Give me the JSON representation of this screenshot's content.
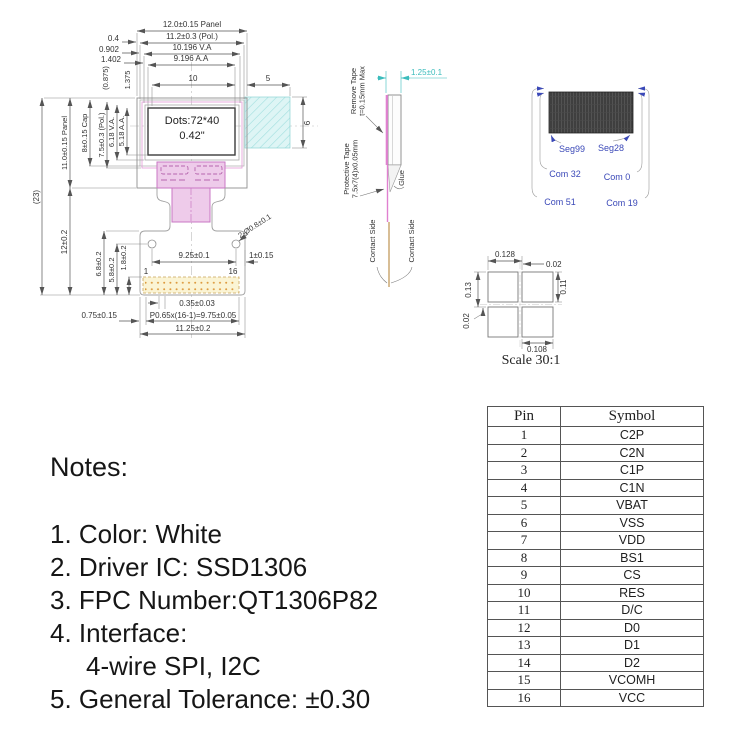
{
  "front_view": {
    "display": {
      "line1": "Dots:72*40",
      "line2": "0.42\""
    },
    "top": {
      "panel": "12.0±0.15 Panel",
      "pol": "11.2±0.3 (Pol.)",
      "va": "10.196 V.A",
      "aa": "9.196 A.A",
      "d04": "0.4",
      "d0902": "0.902",
      "d1402": "1.402",
      "d0875": "(0.875)",
      "d1375": "1.375",
      "d10": "10",
      "d5": "5"
    },
    "left": {
      "total": "(23)",
      "panel": "11.0±0.15 Panel",
      "cap": "8±0.15 Cap",
      "pol": "7.5±0.3 (Pol.)",
      "va": "6.18 V.A.",
      "aa": "5.18 A.A.",
      "fpc": "12±0.2",
      "d68": "6.8±0.2",
      "d58": "5.8±0.2",
      "d18": "1.8±0.2"
    },
    "right": {
      "d6": "6"
    },
    "bottom": {
      "holes": "2-Ø0.8±0.1",
      "d925": "9.25±0.1",
      "d1": "1±0.15",
      "pin1": "1",
      "pin16": "16",
      "d035": "0.35±0.03",
      "pitch": "P0.65x(16-1)=9.75±0.05",
      "d1125": "11.25±0.2",
      "d075": "0.75±0.15"
    }
  },
  "side_view": {
    "remove1": "Remove Tape",
    "remove2": "t=0.15mm Max",
    "thickness": "1.25±0.1",
    "protect1": "Protective Tape",
    "protect2": "7.5x7(4)x0.05mm",
    "glue": "Glue",
    "contact_left": "Contact Side",
    "contact_right": "Contact Side"
  },
  "mapping": {
    "seg_left": "Seg99",
    "seg_right": "Seg28",
    "com_il": "Com 32",
    "com_ir": "Com 0",
    "com_ol": "Com 51",
    "com_or": "Com 19"
  },
  "detail": {
    "d0128": "0.128",
    "d002t": "0.02",
    "d013": "0.13",
    "d011": "0.11",
    "d002l": "0.02",
    "d0108": "0.108",
    "scale": "Scale 30:1"
  },
  "pin_table": {
    "header": {
      "pin": "Pin",
      "symbol": "Symbol"
    },
    "rows": [
      {
        "pin": "1",
        "symbol": "C2P"
      },
      {
        "pin": "2",
        "symbol": "C2N"
      },
      {
        "pin": "3",
        "symbol": "C1P"
      },
      {
        "pin": "4",
        "symbol": "C1N"
      },
      {
        "pin": "5",
        "symbol": "VBAT"
      },
      {
        "pin": "6",
        "symbol": "VSS"
      },
      {
        "pin": "7",
        "symbol": "VDD"
      },
      {
        "pin": "8",
        "symbol": "BS1"
      },
      {
        "pin": "9",
        "symbol": "CS"
      },
      {
        "pin": "10",
        "symbol": "RES"
      },
      {
        "pin": "11",
        "symbol": "D/C"
      },
      {
        "pin": "12",
        "symbol": "D0"
      },
      {
        "pin": "13",
        "symbol": "D1"
      },
      {
        "pin": "14",
        "symbol": "D2"
      },
      {
        "pin": "15",
        "symbol": "VCOMH"
      },
      {
        "pin": "16",
        "symbol": "VCC"
      }
    ]
  },
  "notes": {
    "title": "Notes:",
    "items": [
      "1. Color: White",
      "2. Driver IC: SSD1306",
      "3. FPC Number:QT1306P82",
      "4. Interface:",
      "4-wire SPI, I2C",
      "5. General Tolerance: ±0.30"
    ]
  },
  "colors": {
    "accent_cyan": "#3bbcbc",
    "accent_blue": "#3b49b8",
    "fpc_pink_fill": "#eecbea",
    "fpc_pink_stroke": "#c977c4",
    "pad_yellow": "#fbf4d4",
    "hatch_cyan": "#def5f5",
    "display_dark": "#3f3f3f"
  }
}
